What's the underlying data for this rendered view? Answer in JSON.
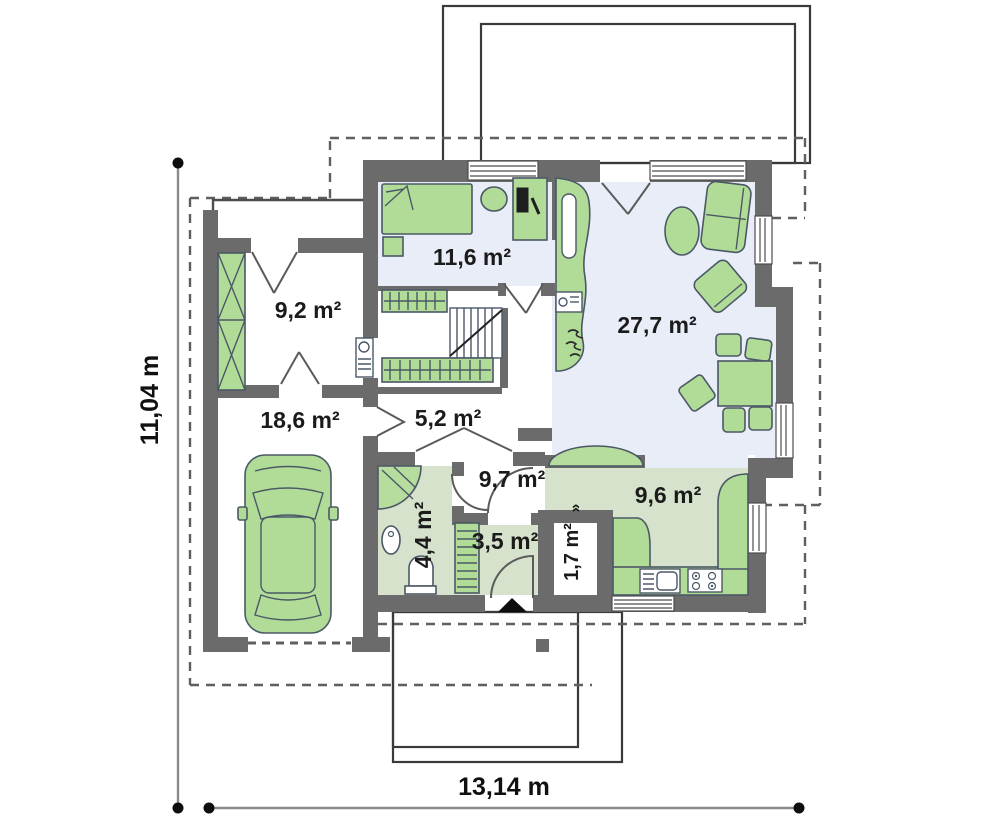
{
  "plan": {
    "title": "house-ground-floor-plan",
    "rooms": [
      {
        "id": "wardrobe-room",
        "label": "9,2 m²"
      },
      {
        "id": "bedroom",
        "label": "11,6 m²"
      },
      {
        "id": "living-room",
        "label": "27,7 m²"
      },
      {
        "id": "garage",
        "label": "18,6 m²"
      },
      {
        "id": "hall",
        "label": "5,2 m²"
      },
      {
        "id": "corridor",
        "label": "9,7 m²"
      },
      {
        "id": "bathroom",
        "label": "4,4 m²"
      },
      {
        "id": "entry-hall",
        "label": "3,5 m²"
      },
      {
        "id": "pantry",
        "label": "1,7 m²"
      },
      {
        "id": "kitchen",
        "label": "9,6 m²"
      }
    ],
    "dimensions": {
      "total_height": "11,04 m",
      "total_width": "13,14 m"
    },
    "symbols": {
      "pantry_door_marker": "»"
    },
    "colors": {
      "wall": "#6b6b6b",
      "furniture_green": "#b1dc98",
      "floor_blue": "#e9edf7",
      "floor_green": "#d6e2cb",
      "arch_green": "#b7dd9e"
    }
  }
}
